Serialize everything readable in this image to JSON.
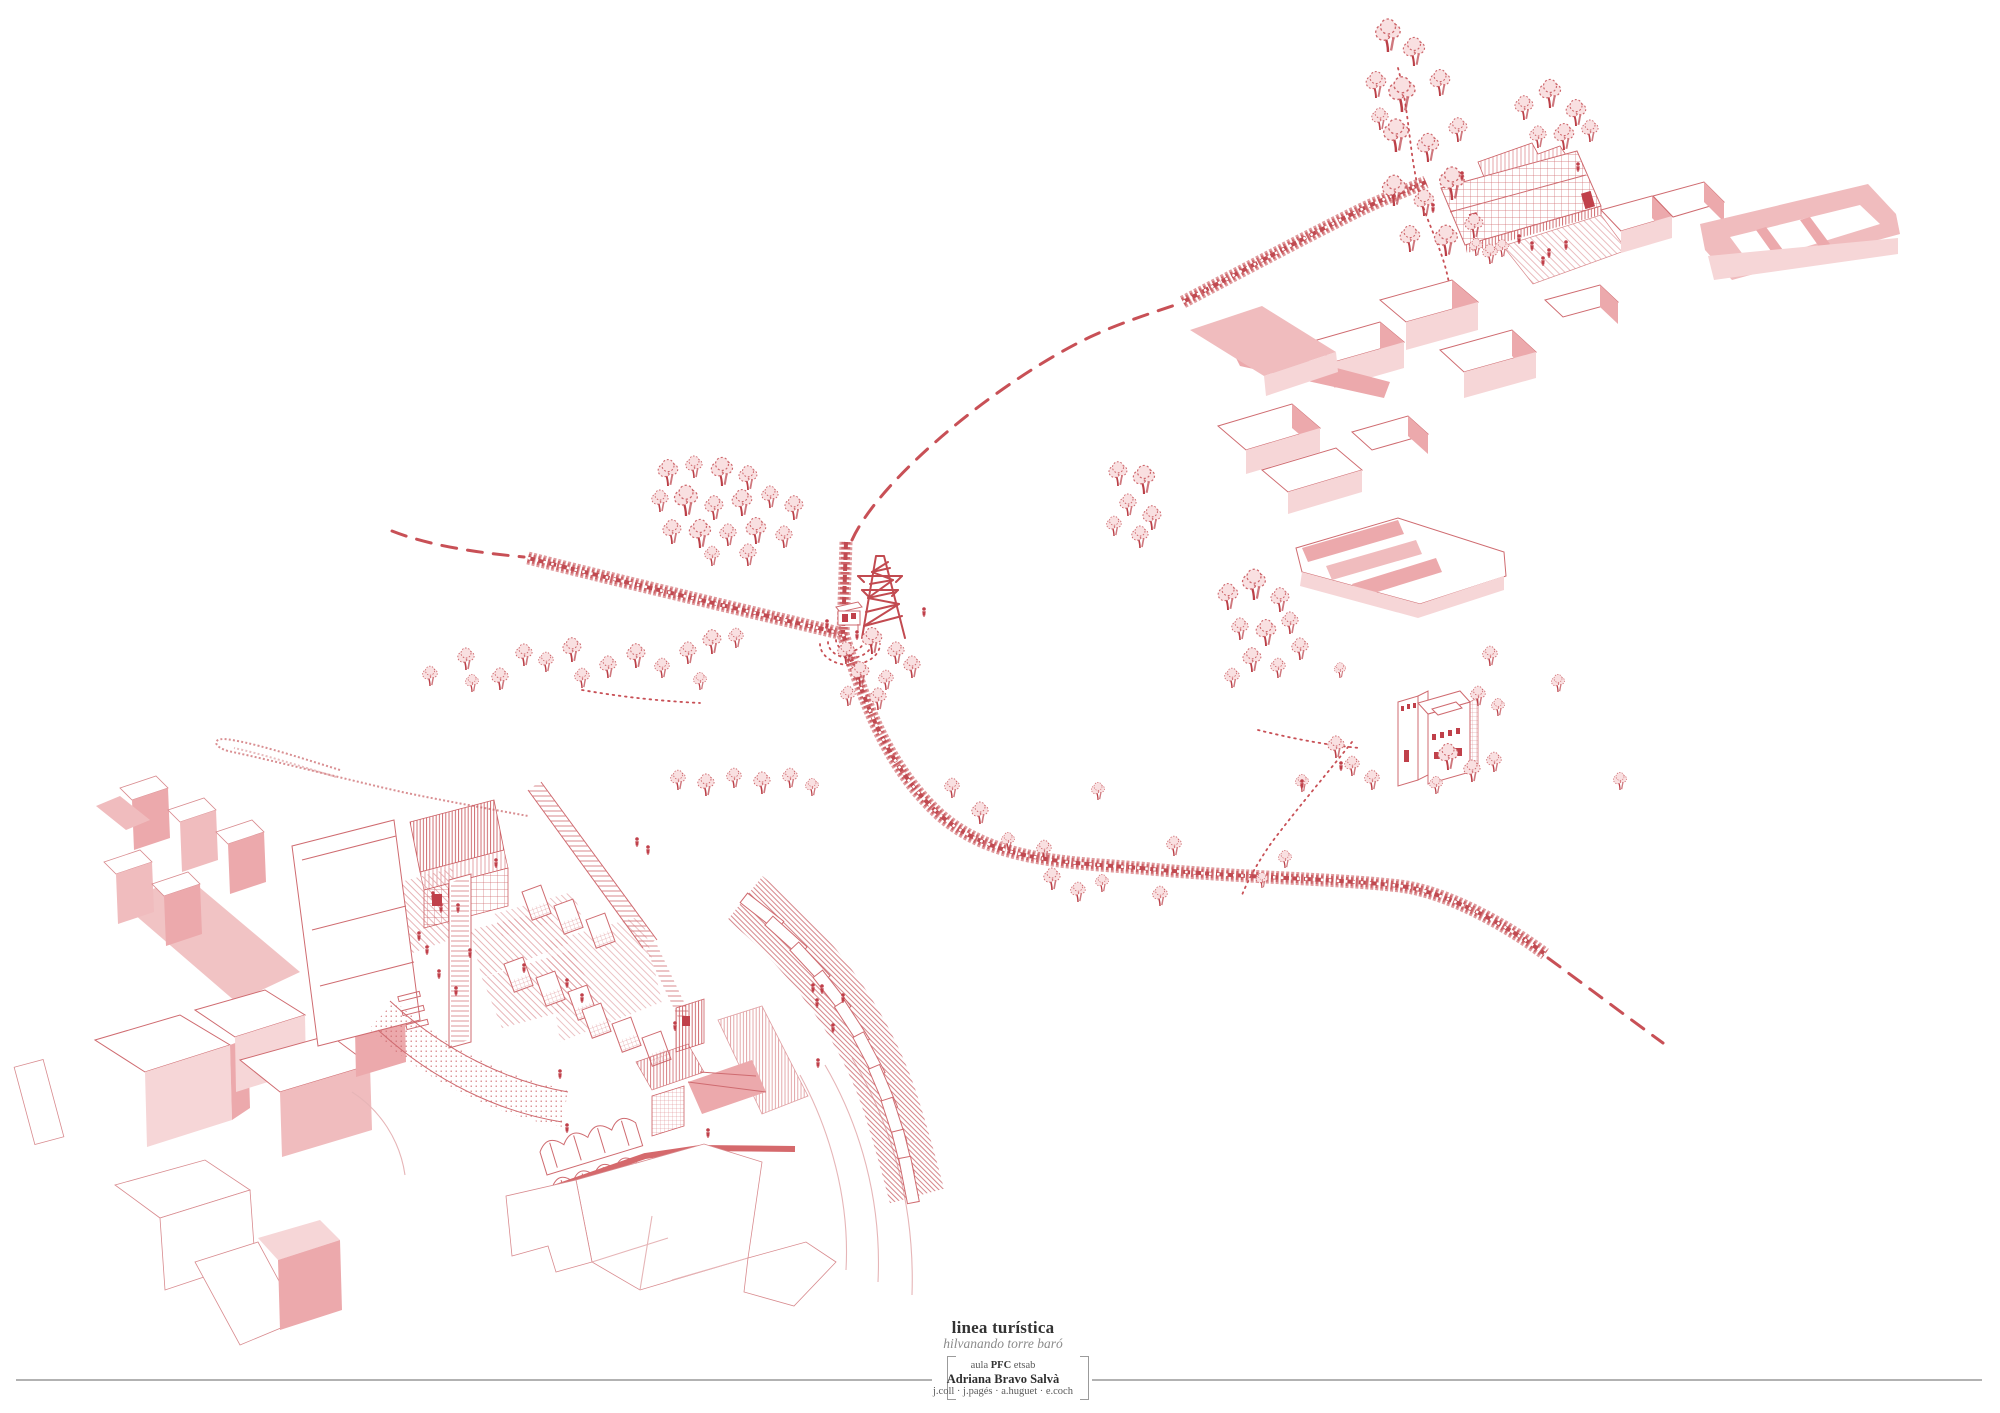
{
  "titles": {
    "title": "linea turística",
    "subtitle": "hilvanando torre baró",
    "credit_line1_pre": "aula ",
    "credit_line1_bold": "PFC",
    "credit_line1_post": " etsab",
    "author": "Adriana Bravo Salvà",
    "tutors": "j.coll · j.pagés · a.huguet · e.coch"
  },
  "palette": {
    "red": "#c85056",
    "red_strong": "#bb3f47",
    "red_mid": "#cd666b",
    "pink": "#eca9ac",
    "pink_light": "#f6d6d7",
    "paper": "#ffffff",
    "rule_gray": "#b2b2b2",
    "text_dark": "#333333",
    "text_gray": "#8a8a8a"
  },
  "drawing": {
    "trees": [
      [
        1388,
        52,
        1.5
      ],
      [
        1414,
        66,
        1.3
      ],
      [
        1376,
        98,
        1.2
      ],
      [
        1402,
        112,
        1.6
      ],
      [
        1440,
        96,
        1.2
      ],
      [
        1396,
        152,
        1.5
      ],
      [
        1428,
        162,
        1.3
      ],
      [
        1458,
        142,
        1.1
      ],
      [
        1394,
        206,
        1.4
      ],
      [
        1424,
        216,
        1.2
      ],
      [
        1452,
        200,
        1.5
      ],
      [
        1410,
        252,
        1.2
      ],
      [
        1446,
        256,
        1.4
      ],
      [
        1474,
        238,
        1.1
      ],
      [
        1380,
        130,
        1.0
      ],
      [
        1524,
        120,
        1.1
      ],
      [
        1550,
        108,
        1.3
      ],
      [
        1576,
        126,
        1.2
      ],
      [
        1538,
        148,
        1.0
      ],
      [
        1564,
        150,
        1.2
      ],
      [
        1590,
        142,
        1.0
      ],
      [
        1476,
        256,
        0.8
      ],
      [
        1490,
        264,
        0.9
      ],
      [
        1502,
        257,
        0.8
      ],
      [
        668,
        486,
        1.2
      ],
      [
        694,
        478,
        1.0
      ],
      [
        722,
        486,
        1.3
      ],
      [
        748,
        490,
        1.1
      ],
      [
        660,
        512,
        1.0
      ],
      [
        686,
        516,
        1.4
      ],
      [
        714,
        520,
        1.1
      ],
      [
        742,
        516,
        1.2
      ],
      [
        770,
        508,
        1.0
      ],
      [
        794,
        520,
        1.1
      ],
      [
        672,
        544,
        1.1
      ],
      [
        700,
        548,
        1.3
      ],
      [
        728,
        546,
        1.0
      ],
      [
        756,
        544,
        1.2
      ],
      [
        784,
        548,
        1.0
      ],
      [
        712,
        566,
        0.9
      ],
      [
        748,
        566,
        1.0
      ],
      [
        430,
        686,
        0.9
      ],
      [
        466,
        670,
        1.0
      ],
      [
        472,
        692,
        0.8
      ],
      [
        500,
        690,
        1.0
      ],
      [
        524,
        666,
        1.0
      ],
      [
        546,
        672,
        0.9
      ],
      [
        572,
        662,
        1.1
      ],
      [
        582,
        688,
        0.9
      ],
      [
        608,
        678,
        1.0
      ],
      [
        636,
        668,
        1.1
      ],
      [
        662,
        678,
        0.9
      ],
      [
        688,
        664,
        1.0
      ],
      [
        712,
        654,
        1.1
      ],
      [
        736,
        648,
        0.9
      ],
      [
        700,
        690,
        0.8
      ],
      [
        846,
        664,
        1.0
      ],
      [
        872,
        654,
        1.2
      ],
      [
        896,
        664,
        1.0
      ],
      [
        860,
        686,
        1.1
      ],
      [
        886,
        690,
        0.9
      ],
      [
        912,
        678,
        1.0
      ],
      [
        848,
        706,
        0.9
      ],
      [
        878,
        710,
        1.0
      ],
      [
        1118,
        486,
        1.1
      ],
      [
        1144,
        494,
        1.3
      ],
      [
        1128,
        516,
        1.0
      ],
      [
        1152,
        530,
        1.1
      ],
      [
        1114,
        536,
        0.9
      ],
      [
        1140,
        548,
        1.0
      ],
      [
        1228,
        610,
        1.2
      ],
      [
        1254,
        600,
        1.4
      ],
      [
        1280,
        612,
        1.1
      ],
      [
        1240,
        640,
        1.0
      ],
      [
        1266,
        646,
        1.2
      ],
      [
        1290,
        634,
        1.0
      ],
      [
        1252,
        672,
        1.1
      ],
      [
        1278,
        678,
        0.9
      ],
      [
        1232,
        688,
        0.9
      ],
      [
        1300,
        660,
        1.0
      ],
      [
        952,
        798,
        0.9
      ],
      [
        980,
        824,
        1.0
      ],
      [
        1008,
        850,
        0.8
      ],
      [
        1044,
        860,
        0.9
      ],
      [
        1098,
        800,
        0.8
      ],
      [
        1174,
        856,
        0.9
      ],
      [
        1052,
        890,
        1.0
      ],
      [
        1078,
        902,
        0.9
      ],
      [
        1102,
        892,
        0.8
      ],
      [
        1160,
        906,
        0.9
      ],
      [
        678,
        790,
        0.9
      ],
      [
        706,
        796,
        1.0
      ],
      [
        734,
        788,
        0.9
      ],
      [
        762,
        794,
        1.0
      ],
      [
        790,
        788,
        0.9
      ],
      [
        812,
        796,
        0.8
      ],
      [
        1336,
        758,
        1.0
      ],
      [
        1352,
        776,
        0.9
      ],
      [
        1372,
        790,
        0.9
      ],
      [
        1302,
        792,
        0.8
      ],
      [
        1448,
        770,
        1.2
      ],
      [
        1472,
        782,
        1.0
      ],
      [
        1494,
        772,
        0.9
      ],
      [
        1478,
        706,
        0.9
      ],
      [
        1498,
        716,
        0.8
      ],
      [
        1436,
        794,
        0.8
      ],
      [
        1620,
        790,
        0.8
      ],
      [
        1558,
        692,
        0.8
      ],
      [
        1340,
        678,
        0.7
      ],
      [
        1285,
        868,
        0.8
      ],
      [
        1262,
        888,
        0.7
      ],
      [
        1490,
        666,
        0.9
      ]
    ],
    "figures": [
      [
        1462,
        181
      ],
      [
        1578,
        172
      ],
      [
        1433,
        213
      ],
      [
        1519,
        244
      ],
      [
        1532,
        251
      ],
      [
        1549,
        258
      ],
      [
        1566,
        250
      ],
      [
        1543,
        266
      ],
      [
        827,
        629
      ],
      [
        857,
        640
      ],
      [
        924,
        617
      ],
      [
        637,
        847
      ],
      [
        648,
        855
      ],
      [
        496,
        868
      ],
      [
        433,
        901
      ],
      [
        441,
        913
      ],
      [
        419,
        941
      ],
      [
        427,
        955
      ],
      [
        458,
        913
      ],
      [
        470,
        958
      ],
      [
        439,
        979
      ],
      [
        456,
        996
      ],
      [
        524,
        973
      ],
      [
        567,
        988
      ],
      [
        582,
        1003
      ],
      [
        675,
        1031
      ],
      [
        560,
        1079
      ],
      [
        567,
        1133
      ],
      [
        708,
        1138
      ],
      [
        818,
        1068
      ],
      [
        813,
        993
      ],
      [
        822,
        994
      ],
      [
        817,
        1008
      ],
      [
        833,
        1033
      ],
      [
        843,
        1003
      ],
      [
        1341,
        771
      ],
      [
        1302,
        789
      ]
    ]
  }
}
